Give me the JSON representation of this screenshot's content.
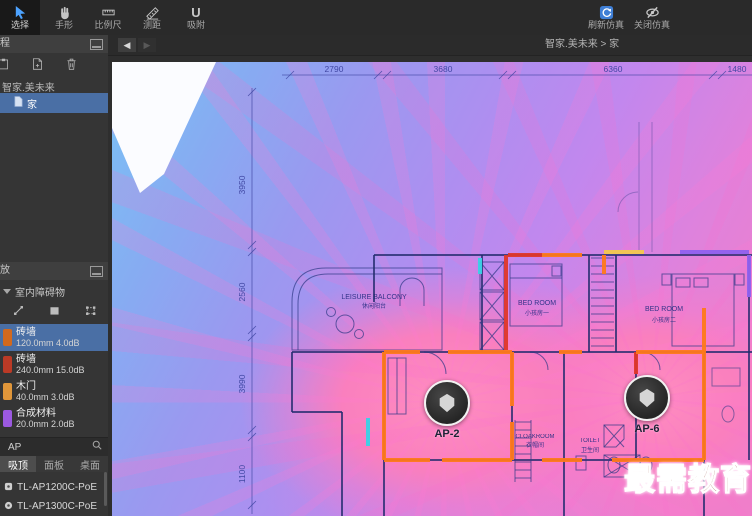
{
  "toolbar": {
    "tools": [
      {
        "label": "选择",
        "active": true
      },
      {
        "label": "手形",
        "active": false
      },
      {
        "label": "比例尺",
        "active": false
      },
      {
        "label": "测距",
        "active": false
      },
      {
        "label": "吸附",
        "active": false
      }
    ],
    "sim_tools": [
      {
        "label": "刷新仿真"
      },
      {
        "label": "关闭仿真"
      }
    ]
  },
  "project_panel": {
    "title": "工程",
    "group_label": "智家.美未来",
    "selected_node": "家"
  },
  "deploy_panel": {
    "title": "布放",
    "category": "室内障碍物",
    "obstacles": [
      {
        "name": "砖墙",
        "spec": "120.0mm 4.0dB",
        "color": "#d2691e",
        "selected": true
      },
      {
        "name": "砖墙",
        "spec": "240.0mm 15.0dB",
        "color": "#bb3a26",
        "selected": false
      },
      {
        "name": "木门",
        "spec": "40.0mm 3.0dB",
        "color": "#e0963a",
        "selected": false
      },
      {
        "name": "合成材料",
        "spec": "20.0mm 2.0dB",
        "color": "#9b59e0",
        "selected": false
      },
      {
        "name": "石棉",
        "spec": "",
        "color": "#43b04a",
        "selected": false
      }
    ],
    "search_value": "AP",
    "tabs": [
      {
        "label": "吸顶",
        "active": true
      },
      {
        "label": "面板",
        "active": false
      },
      {
        "label": "桌面",
        "active": false
      }
    ],
    "ap_models": [
      "TL-AP1200C-PoE",
      "TL-AP1300C-PoE"
    ]
  },
  "canvas": {
    "breadcrumb": "智家.美未来 > 家",
    "dims_top": [
      "2790",
      "3680",
      "6360",
      "1480"
    ],
    "dims_left": [
      "3950",
      "2560",
      "3990",
      "1100"
    ],
    "rooms": [
      {
        "en": "LEISURE BALCONY",
        "zh": "休闲阳台"
      },
      {
        "en": "BED ROOM",
        "zh": "小孩房一"
      },
      {
        "en": "BED ROOM",
        "zh": "小孩房二"
      },
      {
        "en": "CLOAKROOM",
        "zh": "衣帽间"
      },
      {
        "en": "TOILET",
        "zh": "卫生间"
      }
    ],
    "aps": [
      {
        "label": "AP-2"
      },
      {
        "label": "AP-6"
      }
    ],
    "watermark": "最需教育"
  },
  "colors": {
    "selection_blue": "#4a6fa5",
    "sim_accent": "#3f7fd6",
    "heat_blue": "#79c2f5",
    "heat_purple": "#b28cf0",
    "heat_pink": "#f77fbd",
    "wall_orange": "#ff7a1a",
    "wall_red": "#e0372a",
    "wall_cyan": "#3ad2e6",
    "wall_purple": "#9061f0",
    "wall_yellow": "#f4c84e",
    "watermark_red": "#7a1d12"
  }
}
